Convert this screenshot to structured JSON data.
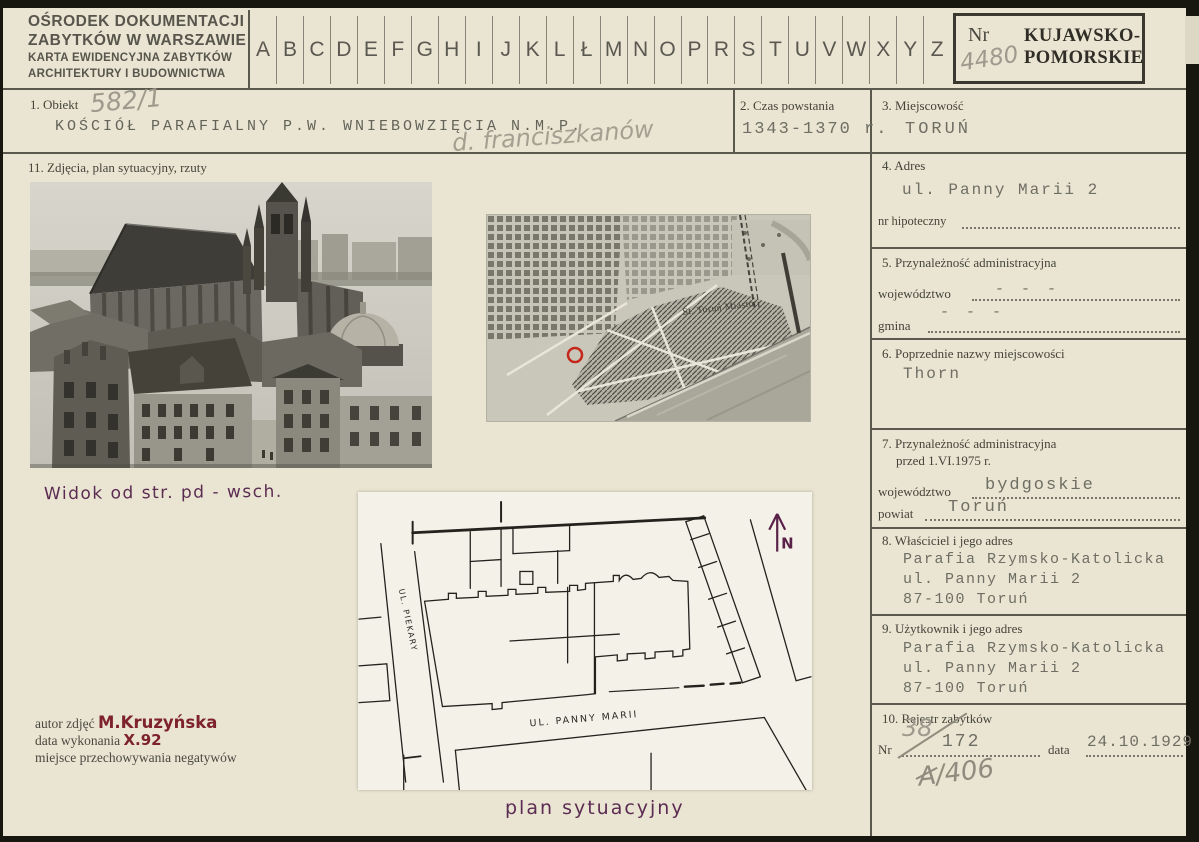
{
  "card": {
    "header": {
      "institution_line1": "OŚRODEK DOKUMENTACJI",
      "institution_line2": "ZABYTKÓW W WARSZAWIE",
      "card_type_line1": "KARTA EWIDENCYJNA ZABYTKÓW",
      "card_type_line2": "ARCHITEKTURY I BUDOWNICTWA",
      "alphabet": [
        "A",
        "B",
        "C",
        "D",
        "E",
        "F",
        "G",
        "H",
        "I",
        "J",
        "K",
        "L",
        "Ł",
        "M",
        "N",
        "O",
        "P",
        "R",
        "S",
        "T",
        "U",
        "V",
        "W",
        "X",
        "Y",
        "Z"
      ],
      "nr_label": "Nr",
      "nr_value": "4480",
      "voivodeship_stamp_line1": "KUJAWSKO-",
      "voivodeship_stamp_line2": "POMORSKIE"
    },
    "fields": {
      "obiekt": {
        "label": "1. Obiekt",
        "ref_number": "582/1",
        "value": "KOŚCIÓŁ PARAFIALNY P.W. WNIEBOWZIĘCIA N.M.P.",
        "annotation": "d. franciszkanów"
      },
      "czas_powstania": {
        "label": "2. Czas powstania",
        "value": "1343-1370 r."
      },
      "miejscowosc": {
        "label": "3. Miejscowość",
        "value": "TORUŃ"
      },
      "adres": {
        "label": "4. Adres",
        "value": "ul. Panny Marii 2",
        "nr_hipoteczny_label": "nr hipoteczny"
      },
      "przynaleznosc": {
        "label": "5. Przynależność administracyjna",
        "wojewodztwo_label": "województwo",
        "wojewodztwo_value": "- - -",
        "gmina_label": "gmina",
        "gmina_value": "- - -"
      },
      "poprzednie_nazwy": {
        "label": "6. Poprzednie nazwy miejscowości",
        "value": "Thorn"
      },
      "przynaleznosc_1975": {
        "label_line1": "7. Przynależność administracyjna",
        "label_line2": "przed 1.VI.1975 r.",
        "wojewodztwo_label": "województwo",
        "wojewodztwo_value": "bydgoskie",
        "powiat_label": "powiat",
        "powiat_value": "Toruń"
      },
      "wlasciciel": {
        "label": "8. Właściciel i jego adres",
        "line1": "Parafia Rzymsko-Katolicka",
        "line2": "ul. Panny Marii 2",
        "line3": "87-100 Toruń"
      },
      "uzytkownik": {
        "label": "9. Użytkownik i jego adres",
        "line1": "Parafia Rzymsko-Katolicka",
        "line2": "ul. Panny Marii 2",
        "line3": "87-100 Toruń"
      },
      "rejestr": {
        "label": "10. Rejestr zabytków",
        "nr_label": "Nr",
        "nr_crossed": "38",
        "nr_value": "172",
        "data_label": "data",
        "data_value": "24.10.1929 r.",
        "annotation": "A/406"
      },
      "zdjecia": {
        "label": "11. Zdjęcia, plan sytuacyjny, rzuty"
      }
    },
    "photo_caption": "Widok od str. pd - wsch.",
    "plan_caption": "plan sytuacyjny",
    "plan_labels": {
      "street_left": "UL. PIEKARY",
      "street_bottom": "UL. PANNY MARII",
      "north": "N"
    },
    "map_label": "St. Toruń Miasto",
    "author_block": {
      "autor_label": "autor zdjęć",
      "autor_value": "M.Kruzyńska",
      "data_label": "data wykonania",
      "data_value": "X.92",
      "negatywy_label": "miejsce przechowywania negatywów"
    },
    "colors": {
      "card_background": "#e9e5d2",
      "print_ink": "#45433a",
      "typewriter_ink": "#6f6e64",
      "pencil": "#9d9a8d",
      "purple_handwriting": "#5c2b52",
      "maroon_handwriting": "#7e222d",
      "map_marker_red": "#c5271a"
    }
  }
}
